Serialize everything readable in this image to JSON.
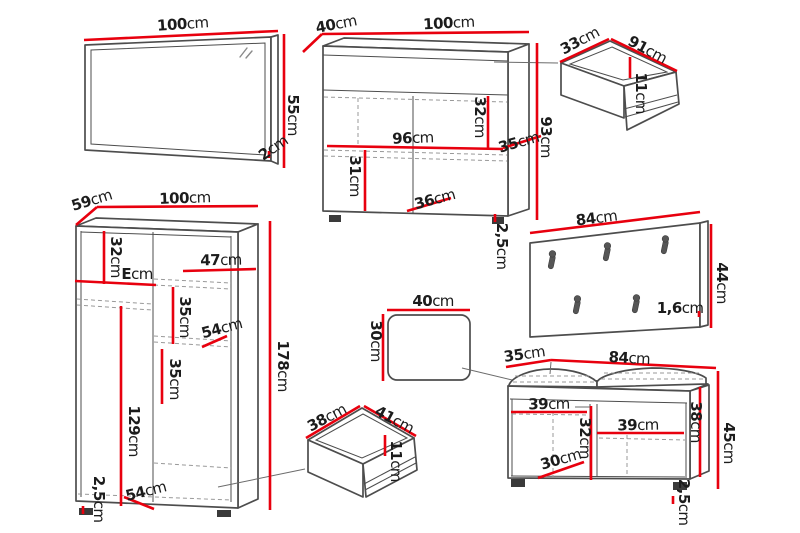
{
  "colors": {
    "background": "#ffffff",
    "dimension_red": "#e8000e",
    "outline_gray": "#4d4d4d",
    "dashed_gray": "#999999",
    "text_black": "#1c1c1c",
    "foot_dark": "#3a3a3a",
    "hook_gray": "#565656"
  },
  "furniture": {
    "mirror": {
      "width": {
        "v": "100",
        "u": "cm"
      },
      "height": {
        "v": "55",
        "u": "cm"
      },
      "thickness": {
        "v": "2",
        "u": "cm"
      }
    },
    "chest": {
      "depth": {
        "v": "40",
        "u": "cm"
      },
      "width": {
        "v": "100",
        "u": "cm"
      },
      "inner_width": {
        "v": "96",
        "u": "cm"
      },
      "drawer_height": {
        "v": "32",
        "u": "cm"
      },
      "shelf_height": {
        "v": "31",
        "u": "cm"
      },
      "door_width": {
        "v": "36",
        "u": "cm"
      },
      "height": {
        "v": "93",
        "u": "cm"
      },
      "top_depth": {
        "v": "35",
        "u": "cm"
      },
      "plinth": {
        "v": "2,5",
        "u": "cm"
      }
    },
    "drawer_large": {
      "depth": {
        "v": "33",
        "u": "cm"
      },
      "width": {
        "v": "91",
        "u": "cm"
      },
      "height": {
        "v": "11",
        "u": "cm"
      }
    },
    "wardrobe": {
      "depth": {
        "v": "59",
        "u": "cm"
      },
      "width": {
        "v": "100",
        "u": "cm"
      },
      "top_shelf_height": {
        "v": "32",
        "u": "cm"
      },
      "shelf_label": {
        "v": "E",
        "u": "cm"
      },
      "shelf_width": {
        "v": "47",
        "u": "cm"
      },
      "gap_upper": {
        "v": "35",
        "u": "cm"
      },
      "mid_shelf_width": {
        "v": "54",
        "u": "cm"
      },
      "gap_lower": {
        "v": "35",
        "u": "cm"
      },
      "height": {
        "v": "178",
        "u": "cm"
      },
      "door_height": {
        "v": "129",
        "u": "cm"
      },
      "bottom_width": {
        "v": "54",
        "u": "cm"
      },
      "plinth": {
        "v": "2,5",
        "u": "cm"
      }
    },
    "coat_panel": {
      "width": {
        "v": "84",
        "u": "cm"
      },
      "height": {
        "v": "44",
        "u": "cm"
      },
      "thickness": {
        "v": "1,6",
        "u": "cm"
      }
    },
    "seat_cushion": {
      "width": {
        "v": "40",
        "u": "cm"
      },
      "height": {
        "v": "30",
        "u": "cm"
      }
    },
    "drawer_small": {
      "depth": {
        "v": "38",
        "u": "cm"
      },
      "width": {
        "v": "41",
        "u": "cm"
      },
      "height": {
        "v": "11",
        "u": "cm"
      }
    },
    "bench": {
      "depth": {
        "v": "35",
        "u": "cm"
      },
      "width": {
        "v": "84",
        "u": "cm"
      },
      "left_compartment_width": {
        "v": "39",
        "u": "cm"
      },
      "right_compartment_width": {
        "v": "39",
        "u": "cm"
      },
      "inner_height": {
        "v": "32",
        "u": "cm"
      },
      "left_inner_width": {
        "v": "30",
        "u": "cm"
      },
      "right_inner_height": {
        "v": "38",
        "u": "cm"
      },
      "height": {
        "v": "45",
        "u": "cm"
      },
      "plinth": {
        "v": "2,5",
        "u": "cm"
      }
    }
  }
}
